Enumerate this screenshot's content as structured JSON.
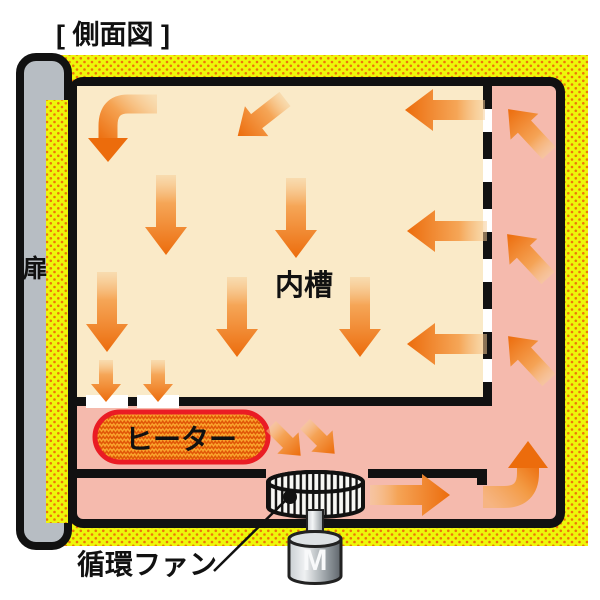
{
  "title": "[ 側面図 ]",
  "labels": {
    "door": "扉",
    "inner_chamber": "内槽",
    "heater": "ヒーター",
    "circulation_fan": "循環ファン",
    "motor": "M"
  },
  "colors": {
    "insulation_yellow": "#EDF70A",
    "insulation_dots": "#EE7509",
    "door_gray": "#B7BDC3",
    "inner_chamber_cream": "#FAEAC8",
    "air_duct_pink": "#F5BAAD",
    "arrow_orange": "#EC6C0C",
    "heater_fill": "#F9A22C",
    "heater_zigzag": "#E05506",
    "heater_border": "#EA1C24",
    "outline_black": "#111111"
  },
  "airflow_arrows": {
    "chamber_down": 5,
    "chamber_down_into_heater_compartment": 2,
    "chamber_left": 3,
    "chamber_diagonal_down_left": 1,
    "chamber_curved_down_top_left": 1,
    "right_duct_up_left": 3,
    "right_duct_curved_up": 1,
    "bottom_duct_right": 1,
    "fan_inlet_diagonal_down_right": 2
  }
}
